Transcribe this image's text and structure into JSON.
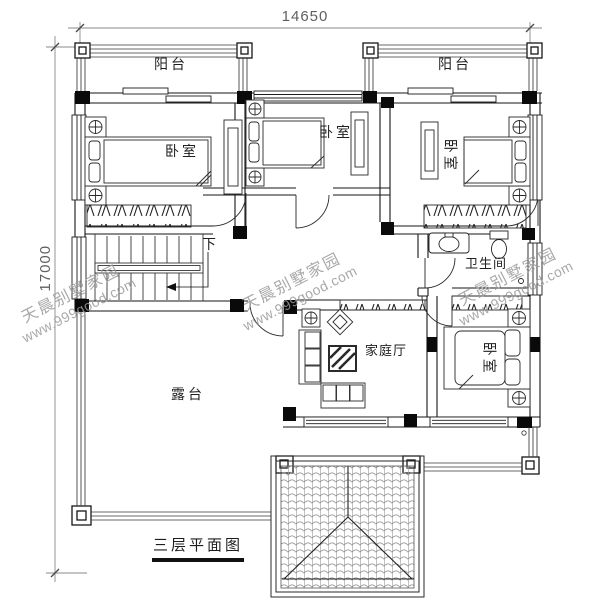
{
  "drawing": {
    "type": "residential floor plan",
    "title": "三层平面图",
    "dimensions": {
      "top_width": "14650",
      "left_height": "17000"
    },
    "rooms": {
      "balcony_left": "阳台",
      "balcony_right": "阳台",
      "bedroom_top_left": "卧室",
      "bedroom_top_middle": "卧室",
      "bedroom_top_right": "卧室",
      "bedroom_bottom_right": "卧室",
      "bathroom": "卫生间",
      "family_hall": "家庭厅",
      "terrace": "露台",
      "stairs_down": "下"
    },
    "watermark": {
      "brand": "天晨别墅家园",
      "url": "www.999good.com"
    },
    "colors": {
      "line": "#1c1c1c",
      "dimension_text": "#5f5f5f",
      "watermark": "#9a9a9a",
      "background": "#ffffff"
    }
  }
}
